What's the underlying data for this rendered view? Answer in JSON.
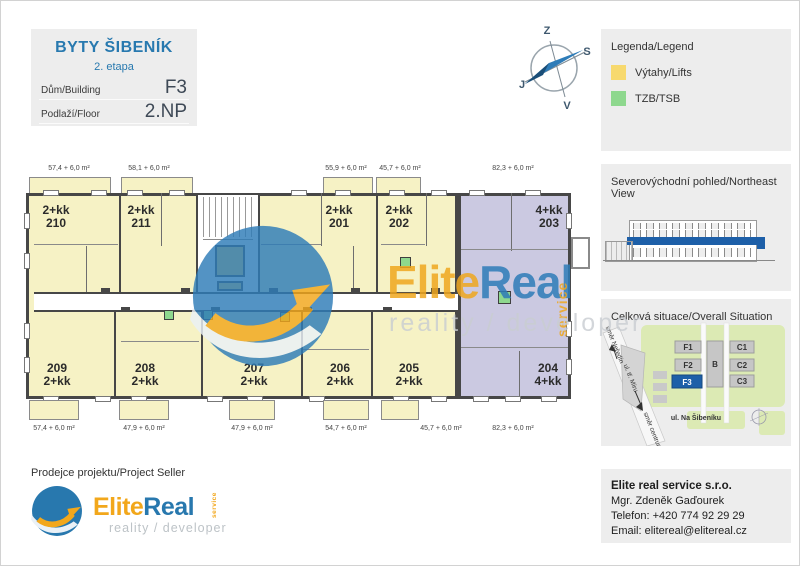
{
  "colors": {
    "accent_blue": "#2878AE",
    "brand_orange": "#F2A71B",
    "unit_yellow": "#F6F2C5",
    "unit_purple": "#CBC9E1",
    "lift_yellow": "#F7D96E",
    "tzb_green": "#8ED88E",
    "floor_highlight": "#1D5FA8"
  },
  "title_block": {
    "project": "BYTY ŠIBENÍK",
    "stage": "2. etapa",
    "building_label": "Dům/Building",
    "building_value": "F3",
    "floor_label": "Podlaží/Floor",
    "floor_value": "2.NP"
  },
  "compass": {
    "west": "Z",
    "north": "S",
    "south": "J",
    "east": "V"
  },
  "legend": {
    "title": "Legenda/Legend",
    "lifts": "Výtahy/Lifts",
    "tzb": "TZB/TSB"
  },
  "northeast_view": {
    "title": "Severovýchodní pohled/Northeast View"
  },
  "situation": {
    "title": "Celková situace/Overall Situation",
    "f1": "F1",
    "f2": "F2",
    "f3": "F3",
    "b": "B",
    "c1": "C1",
    "c2": "C2",
    "c3": "C3",
    "street": "ul. Na Šibeníku",
    "dir_north": "směr Neředín",
    "road": "ul. tř. Míru",
    "dir_centre": "směr centrum"
  },
  "floorplan": {
    "units": [
      {
        "line1": "2+kk",
        "line2": "210",
        "area": "57,4 + 6,0 m²"
      },
      {
        "line1": "2+kk",
        "line2": "211",
        "area": "58,1 + 6,0 m²"
      },
      {
        "line1": "2+kk",
        "line2": "201",
        "area": "55,9 + 6,0 m²"
      },
      {
        "line1": "2+kk",
        "line2": "202",
        "area": "45,7 + 6,0 m²"
      },
      {
        "line1": "4+kk",
        "line2": "203",
        "area": "82,3 + 6,0 m²"
      },
      {
        "line1": "209",
        "line2": "2+kk",
        "area": "57,4 + 6,0 m²"
      },
      {
        "line1": "208",
        "line2": "2+kk",
        "area": "47,9 + 6,0 m²"
      },
      {
        "line1": "207",
        "line2": "2+kk",
        "area": "47,9 + 6,0 m²"
      },
      {
        "line1": "206",
        "line2": "2+kk",
        "area": "54,7 + 6,0 m²"
      },
      {
        "line1": "205",
        "line2": "2+kk",
        "area": "45,7 + 6,0 m²"
      },
      {
        "line1": "204",
        "line2": "4+kk",
        "area": "82,3 + 6,0 m²"
      }
    ]
  },
  "watermark": {
    "elite": "Elite",
    "real": "Real",
    "service": "service",
    "tagline": "reality / developer"
  },
  "seller": {
    "heading": "Prodejce projektu/Project Seller",
    "elite": "Elite",
    "real": "Real",
    "service": "service",
    "tagline": "reality / developer"
  },
  "contact": {
    "company": "Elite real service s.r.o.",
    "person": "Mgr. Zdeněk Gaďourek",
    "phone": "Telefon: +420 774 92 29 29",
    "email": "Email: elitereal@elitereal.cz"
  }
}
